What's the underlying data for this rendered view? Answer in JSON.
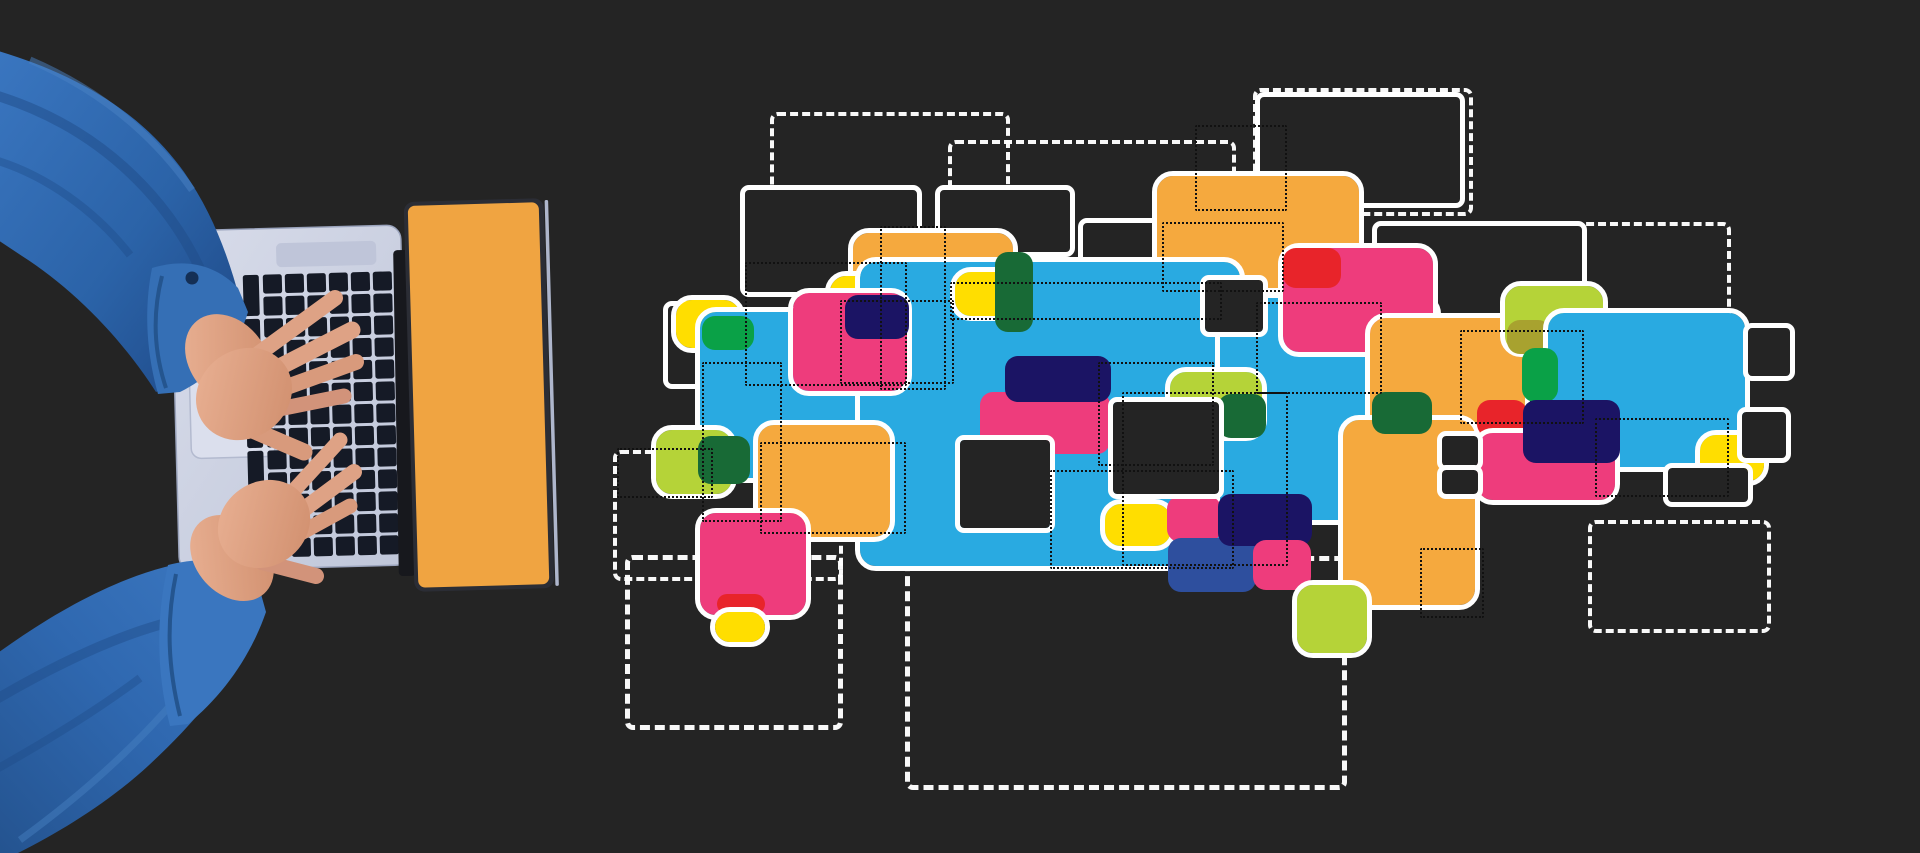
{
  "scene": {
    "description": "Dark studio backdrop; top-down photo of two hands in a blue denim shirt typing on a silver laptop whose open lid is solid orange; to the right floats an abstract collage of overlapping rounded colour blocks, white solid and dashed outline rectangles and small black dotted rectangles.",
    "background": "#242424",
    "canvas": {
      "width": 1920,
      "height": 853
    }
  },
  "palette": {
    "bg": "#242424",
    "white": "#ffffff",
    "blue": "#29aae1",
    "orange": "#f5a93e",
    "yellow": "#ffde00",
    "pink": "#ee3c7c",
    "red": "#e8242a",
    "navy": "#1b1464",
    "steel": "#2e4f9e",
    "green": "#0aa147",
    "dgreen": "#186a36",
    "lime": "#b5d338",
    "olive": "#a8a22f"
  },
  "laptop": {
    "body_color": "#ccd2e4",
    "trackpad_color": "#dbdfed",
    "key_color": "#151a26",
    "screen_color": "#f0a441",
    "bezel_color": "#2b2d35",
    "hinge_color": "#17181d",
    "sleeve_color": "#2e67ad",
    "skin_color": "#dea285",
    "keyboard": {
      "cols": 6,
      "rows": 13,
      "col_start": 266,
      "col_pitch": 22,
      "row_start": 274,
      "row_pitch": 22,
      "key_w": 19,
      "key_h": 19
    }
  },
  "collage": {
    "dotted_white": [
      {
        "name": "dashed-rect-top-left",
        "x": 770,
        "y": 112,
        "w": 232,
        "h": 140
      },
      {
        "name": "dashed-rect-top-center",
        "x": 948,
        "y": 140,
        "w": 280,
        "h": 126
      },
      {
        "name": "dashed-rect-top-right-sm",
        "x": 1253,
        "y": 88,
        "w": 212,
        "h": 120
      },
      {
        "name": "dashed-rect-top-right-lg",
        "x": 1375,
        "y": 222,
        "w": 348,
        "h": 92
      },
      {
        "name": "dashed-rect-left-low",
        "x": 613,
        "y": 450,
        "w": 222,
        "h": 123
      },
      {
        "name": "dashed-rect-bottom-left",
        "x": 625,
        "y": 555,
        "w": 208,
        "h": 165,
        "thick": true
      },
      {
        "name": "dashed-rect-bottom-center",
        "x": 905,
        "y": 556,
        "w": 432,
        "h": 224,
        "thick": true
      },
      {
        "name": "dashed-rect-bottom-right",
        "x": 1588,
        "y": 520,
        "w": 175,
        "h": 105
      }
    ],
    "windows_back": [
      {
        "name": "window-top-left",
        "x": 745,
        "y": 190,
        "w": 172,
        "h": 102
      },
      {
        "name": "window-top-mid",
        "x": 940,
        "y": 190,
        "w": 130,
        "h": 62
      },
      {
        "name": "window-top-mid-2",
        "x": 1083,
        "y": 223,
        "w": 80,
        "h": 94
      },
      {
        "name": "window-top-right",
        "x": 1260,
        "y": 97,
        "w": 200,
        "h": 106
      },
      {
        "name": "window-right-upper",
        "x": 1377,
        "y": 226,
        "w": 205,
        "h": 92
      },
      {
        "name": "window-left-slim",
        "x": 668,
        "y": 306,
        "w": 34,
        "h": 78
      }
    ],
    "shapes": [
      {
        "name": "orange-top-center",
        "x": 1157,
        "y": 176,
        "w": 202,
        "h": 112,
        "f": "orange",
        "ol": true
      },
      {
        "name": "orange-left",
        "x": 853,
        "y": 233,
        "w": 160,
        "h": 118,
        "f": "orange",
        "ol": true
      },
      {
        "name": "yellow-left",
        "x": 676,
        "y": 300,
        "w": 64,
        "h": 48,
        "f": "yellow",
        "ol": true
      },
      {
        "name": "blue-left",
        "x": 700,
        "y": 312,
        "w": 228,
        "h": 166,
        "f": "blue",
        "ol": true
      },
      {
        "name": "green-chip-a",
        "x": 702,
        "y": 316,
        "w": 52,
        "h": 34,
        "f": "green"
      },
      {
        "name": "dgreen-chip-a",
        "x": 853,
        "y": 318,
        "w": 72,
        "h": 28,
        "f": "dgreen"
      },
      {
        "name": "yellow-chip-b",
        "x": 830,
        "y": 276,
        "w": 48,
        "h": 40,
        "f": "yellow",
        "ol": true
      },
      {
        "name": "blue-center",
        "x": 860,
        "y": 262,
        "w": 380,
        "h": 304,
        "f": "blue",
        "ol": true
      },
      {
        "name": "yellow-chip-c",
        "x": 955,
        "y": 272,
        "w": 64,
        "h": 44,
        "f": "yellow",
        "ol": true
      },
      {
        "name": "dgreen-chip-b",
        "x": 995,
        "y": 252,
        "w": 38,
        "h": 80,
        "f": "dgreen"
      },
      {
        "name": "pink-chip-e",
        "x": 980,
        "y": 392,
        "w": 130,
        "h": 62,
        "f": "pink"
      },
      {
        "name": "navy-chip-d",
        "x": 1005,
        "y": 356,
        "w": 106,
        "h": 46,
        "f": "navy"
      },
      {
        "name": "pink-left",
        "x": 793,
        "y": 293,
        "w": 114,
        "h": 98,
        "f": "pink",
        "ol": true
      },
      {
        "name": "navy-chip-a",
        "x": 845,
        "y": 295,
        "w": 64,
        "h": 44,
        "f": "navy"
      },
      {
        "name": "blue-right",
        "x": 1220,
        "y": 298,
        "w": 216,
        "h": 222,
        "f": "blue",
        "ol": true
      },
      {
        "name": "lime-chip-a",
        "x": 1170,
        "y": 372,
        "w": 92,
        "h": 64,
        "f": "lime",
        "ol": true
      },
      {
        "name": "dgreen-chip-c",
        "x": 1218,
        "y": 394,
        "w": 48,
        "h": 44,
        "f": "dgreen"
      },
      {
        "name": "pink-right",
        "x": 1283,
        "y": 248,
        "w": 150,
        "h": 104,
        "f": "pink",
        "ol": true
      },
      {
        "name": "red-chip-a",
        "x": 1283,
        "y": 248,
        "w": 58,
        "h": 40,
        "f": "red"
      },
      {
        "name": "orange-right-a",
        "x": 1370,
        "y": 318,
        "w": 155,
        "h": 115,
        "f": "orange",
        "ol": true
      },
      {
        "name": "orange-right-b",
        "x": 1343,
        "y": 420,
        "w": 132,
        "h": 185,
        "f": "orange",
        "ol": true
      },
      {
        "name": "dgreen-chip-d",
        "x": 1372,
        "y": 392,
        "w": 60,
        "h": 42,
        "f": "dgreen"
      },
      {
        "name": "lime-right",
        "x": 1505,
        "y": 286,
        "w": 98,
        "h": 66,
        "f": "lime",
        "ol": true
      },
      {
        "name": "olive-chip",
        "x": 1507,
        "y": 320,
        "w": 44,
        "h": 34,
        "f": "olive"
      },
      {
        "name": "blue-far-right",
        "x": 1548,
        "y": 313,
        "w": 197,
        "h": 154,
        "f": "blue",
        "ol": true
      },
      {
        "name": "green-chip-b",
        "x": 1522,
        "y": 348,
        "w": 36,
        "h": 54,
        "f": "green"
      },
      {
        "name": "red-chip-b",
        "x": 1477,
        "y": 400,
        "w": 50,
        "h": 37,
        "f": "red"
      },
      {
        "name": "pink-chip-right",
        "x": 1477,
        "y": 433,
        "w": 138,
        "h": 67,
        "f": "pink",
        "ol": true
      },
      {
        "name": "navy-chip-b",
        "x": 1523,
        "y": 400,
        "w": 97,
        "h": 63,
        "f": "navy"
      },
      {
        "name": "yellow-chip-d",
        "x": 1700,
        "y": 435,
        "w": 64,
        "h": 46,
        "f": "yellow",
        "ol": true
      },
      {
        "name": "orange-center",
        "x": 758,
        "y": 425,
        "w": 132,
        "h": 112,
        "f": "orange",
        "ol": true
      },
      {
        "name": "pink-bottom",
        "x": 700,
        "y": 513,
        "w": 106,
        "h": 102,
        "f": "pink",
        "ol": true
      },
      {
        "name": "red-chip-c",
        "x": 717,
        "y": 594,
        "w": 48,
        "h": 20,
        "f": "red"
      },
      {
        "name": "yellow-chip-e",
        "x": 715,
        "y": 612,
        "w": 50,
        "h": 30,
        "f": "yellow",
        "ol": true
      },
      {
        "name": "lime-pair",
        "x": 656,
        "y": 430,
        "w": 76,
        "h": 64,
        "f": "lime",
        "ol": true
      },
      {
        "name": "dgreen-pair",
        "x": 698,
        "y": 436,
        "w": 52,
        "h": 48,
        "f": "dgreen"
      },
      {
        "name": "yellow-chip-f",
        "x": 1105,
        "y": 504,
        "w": 66,
        "h": 42,
        "f": "yellow",
        "ol": true
      },
      {
        "name": "pink-chip-c",
        "x": 1167,
        "y": 496,
        "w": 54,
        "h": 46,
        "f": "pink"
      },
      {
        "name": "steel-chip",
        "x": 1168,
        "y": 538,
        "w": 88,
        "h": 54,
        "f": "steel"
      },
      {
        "name": "navy-chip-c",
        "x": 1218,
        "y": 494,
        "w": 94,
        "h": 52,
        "f": "navy"
      },
      {
        "name": "pink-chip-d",
        "x": 1253,
        "y": 540,
        "w": 58,
        "h": 50,
        "f": "pink"
      },
      {
        "name": "lime-bottom-right",
        "x": 1297,
        "y": 585,
        "w": 70,
        "h": 68,
        "f": "lime",
        "ol": true
      }
    ],
    "windows_front": [
      {
        "name": "window-center-dark",
        "x": 1113,
        "y": 402,
        "w": 106,
        "h": 92
      },
      {
        "name": "window-notch-top",
        "x": 1205,
        "y": 280,
        "w": 58,
        "h": 52
      },
      {
        "name": "window-center-left",
        "x": 960,
        "y": 440,
        "w": 90,
        "h": 88
      },
      {
        "name": "window-right-sm-1",
        "x": 1442,
        "y": 436,
        "w": 36,
        "h": 30
      },
      {
        "name": "window-right-sm-2",
        "x": 1442,
        "y": 470,
        "w": 36,
        "h": 24
      },
      {
        "name": "window-far-right-1",
        "x": 1748,
        "y": 328,
        "w": 42,
        "h": 48
      },
      {
        "name": "window-far-right-2",
        "x": 1742,
        "y": 412,
        "w": 44,
        "h": 46
      },
      {
        "name": "window-under-yellow",
        "x": 1668,
        "y": 468,
        "w": 80,
        "h": 34
      }
    ],
    "black_dotted": [
      {
        "x": 745,
        "y": 262,
        "w": 158,
        "h": 120
      },
      {
        "x": 880,
        "y": 226,
        "w": 62,
        "h": 160
      },
      {
        "x": 950,
        "y": 282,
        "w": 268,
        "h": 34
      },
      {
        "x": 1098,
        "y": 362,
        "w": 112,
        "h": 100
      },
      {
        "x": 760,
        "y": 442,
        "w": 142,
        "h": 88
      },
      {
        "x": 702,
        "y": 362,
        "w": 76,
        "h": 156
      },
      {
        "x": 1256,
        "y": 302,
        "w": 122,
        "h": 88
      },
      {
        "x": 1420,
        "y": 548,
        "w": 60,
        "h": 66
      },
      {
        "x": 1122,
        "y": 392,
        "w": 162,
        "h": 170
      },
      {
        "x": 617,
        "y": 448,
        "w": 92,
        "h": 46
      },
      {
        "x": 1195,
        "y": 125,
        "w": 88,
        "h": 82
      },
      {
        "x": 1050,
        "y": 470,
        "w": 180,
        "h": 95
      },
      {
        "x": 840,
        "y": 300,
        "w": 110,
        "h": 80
      },
      {
        "x": 1162,
        "y": 222,
        "w": 118,
        "h": 66
      },
      {
        "x": 1460,
        "y": 330,
        "w": 120,
        "h": 90
      },
      {
        "x": 1595,
        "y": 418,
        "w": 130,
        "h": 75
      }
    ]
  }
}
